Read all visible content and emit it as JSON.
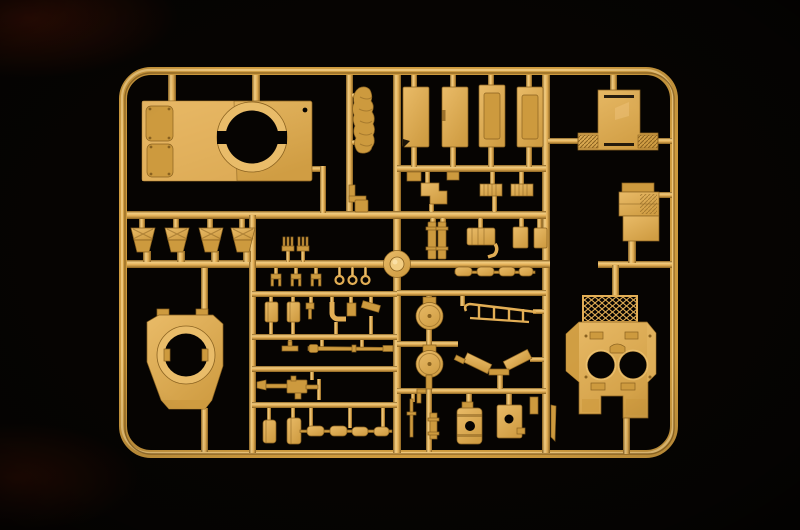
{
  "scene": {
    "type": "photograph",
    "description": "Overhead studio photograph of a dark-yellow injection-molded model kit sprue (plastic parts tree) with tank model parts, lit from above on a pure black background",
    "image_size": {
      "width": 800,
      "height": 530
    },
    "colors": {
      "background": "#000000",
      "plastic-hi": "#f2cd82",
      "plastic-light": "#e2ae55",
      "plastic-mid": "#cd9a3e",
      "plastic-dark": "#8a6220",
      "plastic-deep": "#55380c",
      "hole-black": "#060402"
    },
    "sprue": {
      "material": "polystyrene, matte dark-yellow (dunkelgelb) plastic",
      "frame": {
        "style": "rounded-rectangle",
        "corner_radius_px": 28,
        "runner_width_px": 8
      },
      "parts": [
        {
          "id": "turret-roof-plate",
          "label": "large roof plate with twin rounded hatches and big circular ring opening",
          "count": 1
        },
        {
          "id": "rolled-tarpaulin",
          "label": "rolled tarpaulin stowage piece",
          "count": 1
        },
        {
          "id": "hull-panel",
          "label": "tall rectangular hull side panels",
          "count": 4
        },
        {
          "id": "rear-plate",
          "label": "T-shaped rear plate with textured wings",
          "count": 1
        },
        {
          "id": "stowage-box",
          "label": "stacked rectangular stowage box",
          "count": 1
        },
        {
          "id": "tool-box",
          "label": "small sloped boxes with cross-ribbed lids",
          "count": 4
        },
        {
          "id": "fork-fitting",
          "label": "three-pronged fork fittings",
          "count": 2
        },
        {
          "id": "clevis-fitting",
          "label": "U-shaped clevis fittings",
          "count": 3
        },
        {
          "id": "towing-eye",
          "label": "ring-ended towing eyes",
          "count": 3
        },
        {
          "id": "casemate-ring-plate",
          "label": "angular plate with large circular turret-ring opening",
          "count": 1
        },
        {
          "id": "turret-shell",
          "label": "turret shell with twin round openings and honeycomb mesh grille",
          "count": 1
        },
        {
          "id": "hatch-disc",
          "label": "round hatch discs on hinge collars",
          "count": 2
        },
        {
          "id": "handrail",
          "label": "sloped handrail with stanchions",
          "count": 1
        },
        {
          "id": "mudflap-blade",
          "label": "angled mudflap blades in a V arrangement",
          "count": 2
        },
        {
          "id": "barrel-rod",
          "label": "long thin barrel rod with collars",
          "count": 1
        },
        {
          "id": "machine-gun",
          "label": "machine gun with conical flash hider",
          "count": 1
        },
        {
          "id": "fuel-drum",
          "label": "banded cylindrical drum with round port",
          "count": 1
        },
        {
          "id": "ported-box",
          "label": "small box with round port",
          "count": 1
        },
        {
          "id": "small-fittings",
          "label": "assorted small brackets, pins, ribbed blocks, elbows and pill-shaped links",
          "count": 30
        },
        {
          "id": "injection-hub",
          "label": "round central injection gate boss",
          "count": 1
        }
      ]
    }
  }
}
